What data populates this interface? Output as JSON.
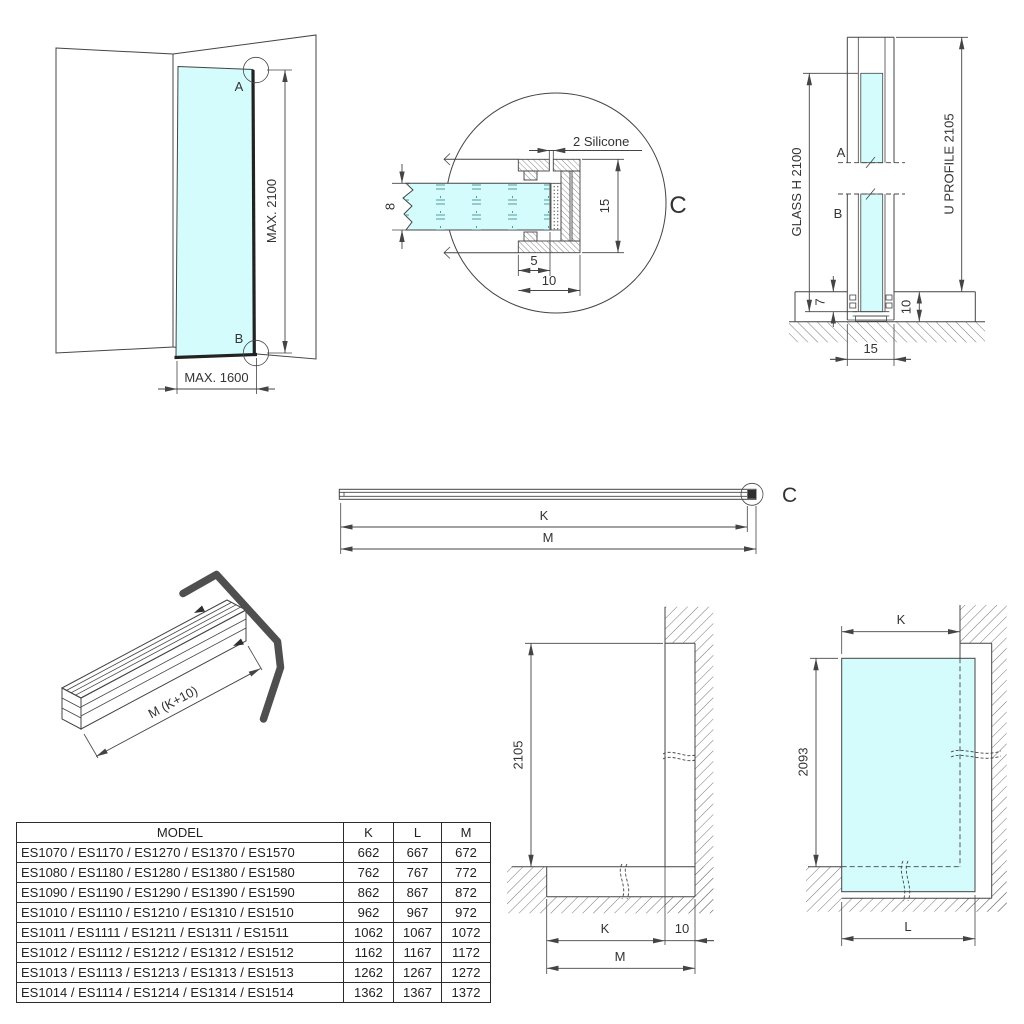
{
  "drawing": {
    "corner_view": {
      "label_a": "A",
      "label_b": "B",
      "max_height": "MAX. 2100",
      "max_width": "MAX. 1600"
    },
    "detail_view": {
      "label": "C",
      "silicone_note": "2 Silicone",
      "dim_glass": "8",
      "dim_height": "15",
      "dim_depth": "5",
      "dim_width": "10"
    },
    "section_view": {
      "label_a": "A",
      "label_b": "B",
      "glass_label": "GLASS H 2100",
      "profile_label": "U PROFILE 2105",
      "dim_floor": "7",
      "dim_recess": "10",
      "dim_width": "15"
    },
    "profile_view": {
      "label": "C",
      "dim_k": "K",
      "dim_m": "M"
    },
    "profile_3d": {
      "dim_length": "M (K+10)"
    },
    "wall_elevation": {
      "dim_height": "2105",
      "dim_k": "K",
      "dim_offset": "10",
      "dim_m": "M"
    },
    "glass_elevation": {
      "dim_k": "K",
      "dim_height": "2093",
      "dim_l": "L"
    }
  },
  "table": {
    "headers": [
      "MODEL",
      "K",
      "L",
      "M"
    ],
    "rows": [
      {
        "model": "ES1070 / ES1170 / ES1270 / ES1370 / ES1570",
        "k": "662",
        "l": "667",
        "m": "672"
      },
      {
        "model": "ES1080 / ES1180 / ES1280 / ES1380 / ES1580",
        "k": "762",
        "l": "767",
        "m": "772"
      },
      {
        "model": "ES1090 / ES1190 / ES1290 / ES1390 / ES1590",
        "k": "862",
        "l": "867",
        "m": "872"
      },
      {
        "model": "ES1010 / ES1110 / ES1210 / ES1310 / ES1510",
        "k": "962",
        "l": "967",
        "m": "972"
      },
      {
        "model": "ES1011 / ES1111 / ES1211 / ES1311 / ES1511",
        "k": "1062",
        "l": "1067",
        "m": "1072"
      },
      {
        "model": "ES1012 / ES1112 / ES1212 / ES1312 / ES1512",
        "k": "1162",
        "l": "1167",
        "m": "1172"
      },
      {
        "model": "ES1013 / ES1113 / ES1213 / ES1313 / ES1513",
        "k": "1262",
        "l": "1267",
        "m": "1272"
      },
      {
        "model": "ES1014 / ES1114 / ES1214 / ES1314 / ES1514",
        "k": "1362",
        "l": "1367",
        "m": "1372"
      }
    ]
  },
  "colors": {
    "line": "#444444",
    "glass": "#d5fcfc",
    "cap": "#4f4f4f"
  }
}
